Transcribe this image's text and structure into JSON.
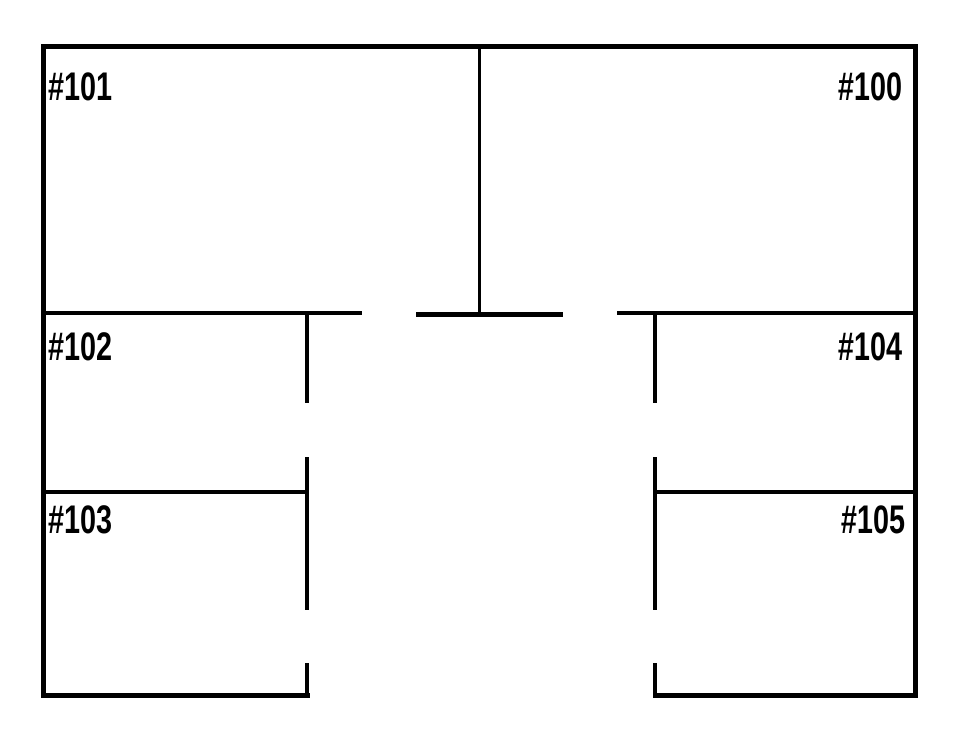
{
  "page": {
    "background": "#ffffff",
    "wall_color": "#000000",
    "label_color": "#000000",
    "type": "floor-plan"
  },
  "floorplan": {
    "rooms": [
      {
        "id": "room-101",
        "label": "#101",
        "position": "top-left"
      },
      {
        "id": "room-100",
        "label": "#100",
        "position": "top-right"
      },
      {
        "id": "room-102",
        "label": "#102",
        "position": "middle-left"
      },
      {
        "id": "room-104",
        "label": "#104",
        "position": "middle-right"
      },
      {
        "id": "room-103",
        "label": "#103",
        "position": "bottom-left"
      },
      {
        "id": "room-105",
        "label": "#105",
        "position": "bottom-right"
      }
    ]
  }
}
